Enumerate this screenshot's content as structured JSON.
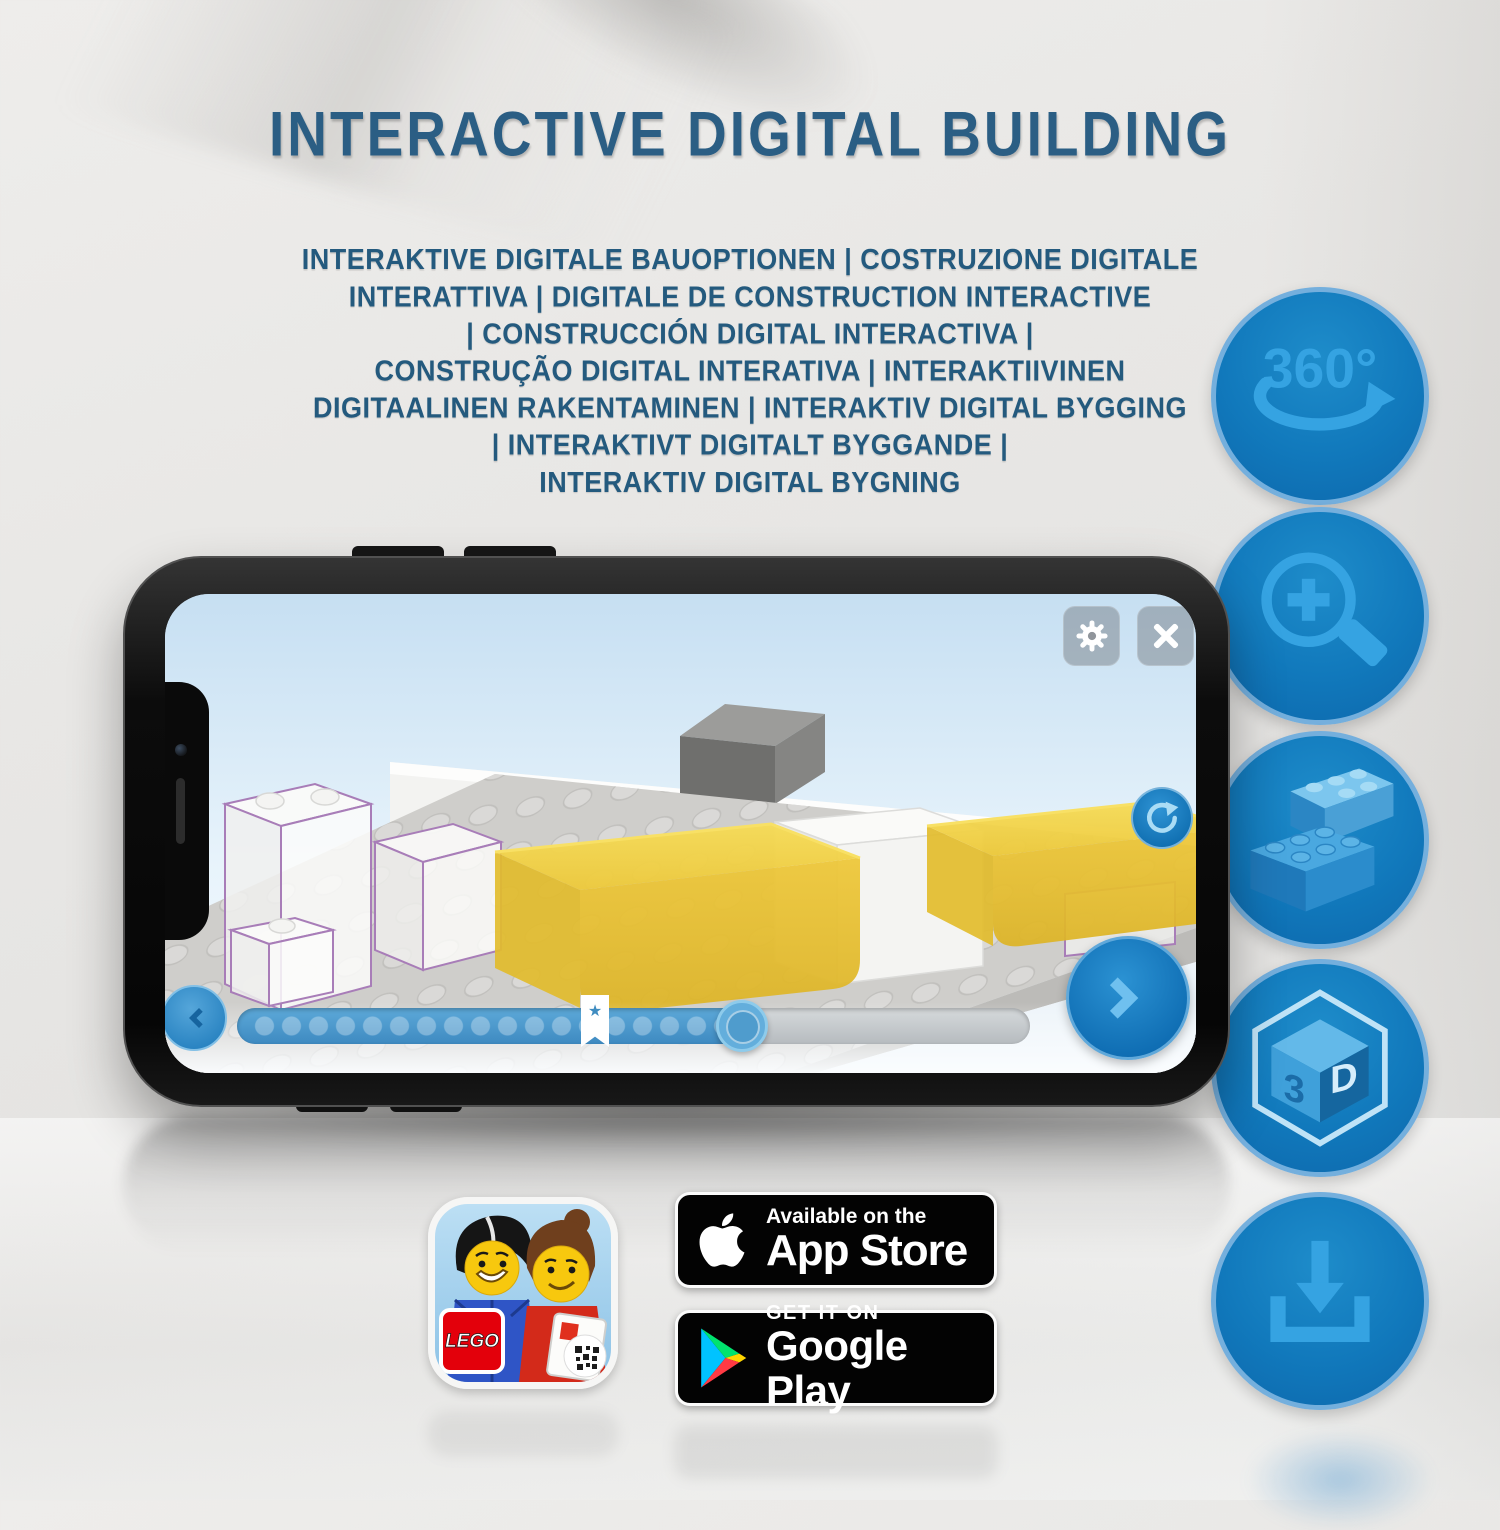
{
  "title": "INTERACTIVE DIGITAL BUILDING",
  "subtitle_lines": [
    "INTERAKTIVE DIGITALE BAUOPTIONEN | COSTRUZIONE DIGITALE",
    "INTERATTIVA | DIGITALE DE CONSTRUCTION INTERACTIVE",
    "| CONSTRUCCIÓN DIGITAL INTERACTIVA |",
    "CONSTRUÇÃO DIGITAL INTERATIVA | INTERAKTIIVINEN",
    "DIGITAALINEN RAKENTAMINEN | INTERAKTIV DIGITAL BYGGING",
    "| INTERAKTIVT DIGITALT BYGGANDE |",
    "INTERAKTIV DIGITAL BYGNING"
  ],
  "feature_icons": [
    {
      "name": "360-rotation-icon",
      "label": "360°"
    },
    {
      "name": "zoom-in-icon"
    },
    {
      "name": "lego-bricks-icon"
    },
    {
      "name": "3d-cube-icon",
      "left": "3",
      "right": "D"
    },
    {
      "name": "download-icon"
    }
  ],
  "phone_app": {
    "icons": [
      "gear-icon",
      "close-icon",
      "rotate-icon",
      "chevron-left-icon",
      "chevron-right-icon",
      "bookmark-star-icon"
    ],
    "slider": {
      "star_glyph": "★"
    }
  },
  "badges": {
    "app_store": {
      "line1": "Available on the",
      "line2": "App Store"
    },
    "google_play": {
      "line1": "GET IT ON",
      "line2": "Google Play"
    },
    "lego_app_icon": {
      "logo_text": "LEGO"
    }
  },
  "colors": {
    "title_blue": "#2b5e84",
    "circle_blue": "#1179bc",
    "icon_glyph_blue": "#35a3e2",
    "lego_red": "#e3000b",
    "badge_black": "#030303",
    "yellow_brick": "#edc93a"
  }
}
